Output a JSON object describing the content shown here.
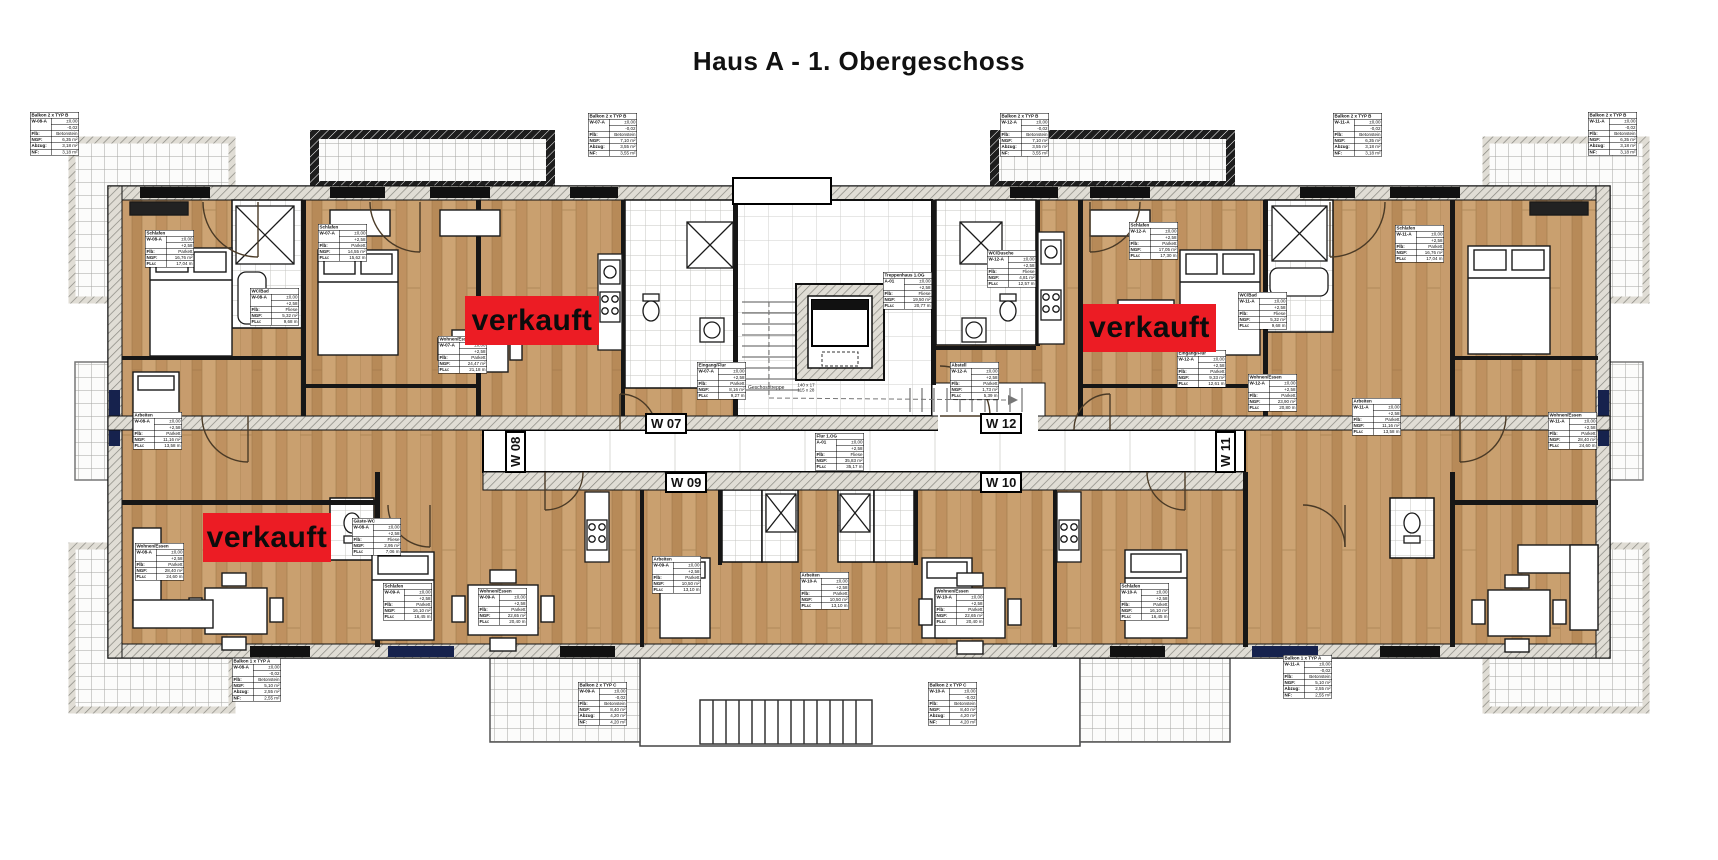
{
  "title": "Haus A - 1. Obergeschoss",
  "colors": {
    "sold_red": "#ec1c24",
    "wood_base": "#c49a6a",
    "wall_hatch": "#e0ddd5",
    "wall_dark": "#161616",
    "window_blue": "#16224d"
  },
  "sold_labels": [
    {
      "text": "verkauft",
      "x": 465,
      "y": 296,
      "w": 134,
      "h": 49
    },
    {
      "text": "verkauft",
      "x": 1083,
      "y": 304,
      "w": 133,
      "h": 48
    },
    {
      "text": "verkauft",
      "x": 203,
      "y": 513,
      "w": 128,
      "h": 49
    }
  ],
  "apartment_labels": [
    {
      "text": "W 07",
      "x": 645,
      "y": 413,
      "vertical": false
    },
    {
      "text": "W 08",
      "x": 505,
      "y": 473,
      "vertical": true
    },
    {
      "text": "W 09",
      "x": 665,
      "y": 472,
      "vertical": false
    },
    {
      "text": "W 10",
      "x": 980,
      "y": 472,
      "vertical": false
    },
    {
      "text": "W 11",
      "x": 1215,
      "y": 473,
      "vertical": true
    },
    {
      "text": "W 12",
      "x": 980,
      "y": 413,
      "vertical": false
    }
  ],
  "stair_note": {
    "label": "Geschosstreppe",
    "dims": [
      "140 x 17",
      "115 x 28"
    ],
    "x": 748,
    "y": 383
  },
  "tables": [
    {
      "x": 30,
      "y": 112,
      "title": "Balkon 2 x TYP B",
      "unit": "W-08-A",
      "levels": [
        "±0,00",
        "-0,02"
      ],
      "rows": [
        [
          "Flb:",
          "Betonstein"
        ],
        [
          "NGF:",
          "6,35 m²"
        ],
        [
          "Abzug:",
          "3,18 m²"
        ],
        [
          "NF:",
          "3,18 m²"
        ]
      ]
    },
    {
      "x": 588,
      "y": 113,
      "title": "Balkon 2 x TYP B",
      "unit": "W-07-A",
      "levels": [
        "±0,00",
        "-0,02"
      ],
      "rows": [
        [
          "Flb:",
          "Betonstein"
        ],
        [
          "NGF:",
          "7,10 m²"
        ],
        [
          "Abzug:",
          "3,55 m²"
        ],
        [
          "NF:",
          "3,55 m²"
        ]
      ]
    },
    {
      "x": 1000,
      "y": 113,
      "title": "Balkon 2 x TYP B",
      "unit": "W-12-A",
      "levels": [
        "±0,00",
        "-0,02"
      ],
      "rows": [
        [
          "Flb:",
          "Betonstein"
        ],
        [
          "NGF:",
          "7,10 m²"
        ],
        [
          "Abzug:",
          "3,55 m²"
        ],
        [
          "NF:",
          "3,55 m²"
        ]
      ]
    },
    {
      "x": 1333,
      "y": 113,
      "title": "Balkon 2 x TYP B",
      "unit": "W-11-A",
      "levels": [
        "±0,00",
        "-0,02"
      ],
      "rows": [
        [
          "Flb:",
          "Betonstein"
        ],
        [
          "NGF:",
          "6,35 m²"
        ],
        [
          "Abzug:",
          "3,18 m²"
        ],
        [
          "NF:",
          "3,18 m²"
        ]
      ]
    },
    {
      "x": 1588,
      "y": 112,
      "title": "Balkon 2 x TYP B",
      "unit": "W-11-A",
      "levels": [
        "±0,00",
        "-0,02"
      ],
      "rows": [
        [
          "Flb:",
          "Betonstein"
        ],
        [
          "NGF:",
          "6,35 m²"
        ],
        [
          "Abzug:",
          "3,18 m²"
        ],
        [
          "NF:",
          "3,18 m²"
        ]
      ]
    },
    {
      "x": 232,
      "y": 658,
      "title": "Balkon 1 x TYP A",
      "unit": "W-08-A",
      "levels": [
        "±0,00",
        "-0,02"
      ],
      "rows": [
        [
          "Flb:",
          "Betonstein"
        ],
        [
          "NGF:",
          "5,10 m²"
        ],
        [
          "Abzug:",
          "2,55 m²"
        ],
        [
          "NF:",
          "2,55 m²"
        ]
      ]
    },
    {
      "x": 578,
      "y": 682,
      "title": "Balkon 2 x TYP C",
      "unit": "W-09-A",
      "levels": [
        "±0,00",
        "-0,02"
      ],
      "rows": [
        [
          "Flb:",
          "Betonstein"
        ],
        [
          "NGF:",
          "8,40 m²"
        ],
        [
          "Abzug:",
          "4,20 m²"
        ],
        [
          "NF:",
          "4,20 m²"
        ]
      ]
    },
    {
      "x": 928,
      "y": 682,
      "title": "Balkon 2 x TYP C",
      "unit": "W-10-A",
      "levels": [
        "±0,00",
        "-0,02"
      ],
      "rows": [
        [
          "Flb:",
          "Betonstein"
        ],
        [
          "NGF:",
          "8,40 m²"
        ],
        [
          "Abzug:",
          "4,20 m²"
        ],
        [
          "NF:",
          "4,20 m²"
        ]
      ]
    },
    {
      "x": 1283,
      "y": 655,
      "title": "Balkon 1 x TYP A",
      "unit": "W-11-A",
      "levels": [
        "±0,00",
        "-0,02"
      ],
      "rows": [
        [
          "Flb:",
          "Betonstein"
        ],
        [
          "NGF:",
          "5,10 m²"
        ],
        [
          "Abzug:",
          "2,55 m²"
        ],
        [
          "NF:",
          "2,55 m²"
        ]
      ]
    },
    {
      "x": 145,
      "y": 230,
      "title": "Schlafen",
      "unit": "W-08-A",
      "levels": [
        "±0,00",
        "+2,58"
      ],
      "rows": [
        [
          "Flb:",
          "Parkett"
        ],
        [
          "NGF:",
          "16,76 m²"
        ],
        [
          "FLu:",
          "17,04 m"
        ]
      ]
    },
    {
      "x": 250,
      "y": 288,
      "title": "WC/Bad",
      "unit": "W-08-A",
      "levels": [
        "±0,00",
        "+2,58"
      ],
      "rows": [
        [
          "Flb:",
          "Fliese"
        ],
        [
          "NGF:",
          "5,32 m²"
        ],
        [
          "FLu:",
          "9,68 m"
        ]
      ]
    },
    {
      "x": 318,
      "y": 224,
      "title": "Schlafen",
      "unit": "W-07-A",
      "levels": [
        "±0,00",
        "+2,58"
      ],
      "rows": [
        [
          "Flb:",
          "Parkett"
        ],
        [
          "NGF:",
          "14,55 m²"
        ],
        [
          "FLu:",
          "15,62 m"
        ]
      ]
    },
    {
      "x": 438,
      "y": 336,
      "title": "Wohnen/Essen",
      "unit": "W-07-A",
      "levels": [
        "±0,00",
        "+2,58"
      ],
      "rows": [
        [
          "Flb:",
          "Parkett"
        ],
        [
          "NGF:",
          "24,47 m²"
        ],
        [
          "FLu:",
          "21,18 m"
        ]
      ]
    },
    {
      "x": 697,
      "y": 362,
      "title": "Eingang/Flur",
      "unit": "W-07-A",
      "levels": [
        "±0,00",
        "+2,58"
      ],
      "rows": [
        [
          "Flb:",
          "Parkett"
        ],
        [
          "NGF:",
          "8,16 m²"
        ],
        [
          "FLu:",
          "9,27 m"
        ]
      ]
    },
    {
      "x": 883,
      "y": 272,
      "title": "Treppenhaus 1.OG",
      "unit": "A-01",
      "levels": [
        "±0,00",
        "+2,58"
      ],
      "rows": [
        [
          "Flb:",
          "Fliese"
        ],
        [
          "NGF:",
          "19,50 m²"
        ],
        [
          "FLu:",
          "20,77 m"
        ]
      ]
    },
    {
      "x": 987,
      "y": 250,
      "title": "WC/Dusche",
      "unit": "W-12-A",
      "levels": [
        "±0,00",
        "+2,58"
      ],
      "rows": [
        [
          "Flb:",
          "Fliese"
        ],
        [
          "NGF:",
          "4,81 m²"
        ],
        [
          "FLu:",
          "12,57 m"
        ]
      ]
    },
    {
      "x": 950,
      "y": 362,
      "title": "Abstell",
      "unit": "W-12-A",
      "levels": [
        "±0,00",
        "+2,58"
      ],
      "rows": [
        [
          "Flb:",
          "Parkett"
        ],
        [
          "NGF:",
          "1,73 m²"
        ],
        [
          "FLu:",
          "5,39 m"
        ]
      ]
    },
    {
      "x": 1177,
      "y": 350,
      "title": "Eingang/Flur",
      "unit": "W-12-A",
      "levels": [
        "±0,00",
        "+2,58"
      ],
      "rows": [
        [
          "Flb:",
          "Parkett"
        ],
        [
          "NGF:",
          "9,33 m²"
        ],
        [
          "FLu:",
          "12,61 m"
        ]
      ]
    },
    {
      "x": 1248,
      "y": 374,
      "title": "Wohnen/Essen",
      "unit": "W-12-A",
      "levels": [
        "±0,00",
        "+2,58"
      ],
      "rows": [
        [
          "Flb:",
          "Parkett"
        ],
        [
          "NGF:",
          "23,90 m²"
        ],
        [
          "FLu:",
          "20,80 m"
        ]
      ]
    },
    {
      "x": 815,
      "y": 433,
      "title": "Flur 1.OG",
      "unit": "A-01",
      "levels": [
        "±0,00",
        "+2,58"
      ],
      "rows": [
        [
          "Flb:",
          "Fliese"
        ],
        [
          "NGF:",
          "35,83 m²"
        ],
        [
          "FLu:",
          "35,17 m"
        ]
      ]
    },
    {
      "x": 352,
      "y": 518,
      "title": "Gäste-WC",
      "unit": "W-08-A",
      "levels": [
        "±0,00",
        "+2,58"
      ],
      "rows": [
        [
          "Flb:",
          "Fliese"
        ],
        [
          "NGF:",
          "2,95 m²"
        ],
        [
          "FLu:",
          "7,06 m"
        ]
      ]
    },
    {
      "x": 1129,
      "y": 222,
      "title": "Schlafen",
      "unit": "W-12-A",
      "levels": [
        "±0,00",
        "+2,58"
      ],
      "rows": [
        [
          "Flb:",
          "Parkett"
        ],
        [
          "NGF:",
          "17,05 m²"
        ],
        [
          "FLu:",
          "17,30 m"
        ]
      ]
    },
    {
      "x": 1395,
      "y": 225,
      "title": "Schlafen",
      "unit": "W-11-A",
      "levels": [
        "±0,00",
        "+2,58"
      ],
      "rows": [
        [
          "Flb:",
          "Parkett"
        ],
        [
          "NGF:",
          "16,76 m²"
        ],
        [
          "FLu:",
          "17,04 m"
        ]
      ]
    },
    {
      "x": 1238,
      "y": 292,
      "title": "WC/Bad",
      "unit": "W-11-A",
      "levels": [
        "±0,00",
        "+2,58"
      ],
      "rows": [
        [
          "Flb:",
          "Fliese"
        ],
        [
          "NGF:",
          "5,32 m²"
        ],
        [
          "FLu:",
          "9,68 m"
        ]
      ]
    },
    {
      "x": 133,
      "y": 412,
      "title": "Arbeiten",
      "unit": "W-08-A",
      "levels": [
        "±0,00",
        "+2,58"
      ],
      "rows": [
        [
          "Flb:",
          "Parkett"
        ],
        [
          "NGF:",
          "11,16 m²"
        ],
        [
          "FLu:",
          "13,58 m"
        ]
      ]
    },
    {
      "x": 135,
      "y": 543,
      "title": "Wohnen/Essen",
      "unit": "W-08-A",
      "levels": [
        "±0,00",
        "+2,58"
      ],
      "rows": [
        [
          "Flb:",
          "Parkett"
        ],
        [
          "NGF:",
          "28,40 m²"
        ],
        [
          "FLu:",
          "24,60 m"
        ]
      ]
    },
    {
      "x": 383,
      "y": 583,
      "title": "Schlafen",
      "unit": "W-09-A",
      "levels": [
        "±0,00",
        "+2,58"
      ],
      "rows": [
        [
          "Flb:",
          "Parkett"
        ],
        [
          "NGF:",
          "16,10 m²"
        ],
        [
          "FLu:",
          "16,45 m"
        ]
      ]
    },
    {
      "x": 478,
      "y": 588,
      "title": "Wohnen/Essen",
      "unit": "W-09-A",
      "levels": [
        "±0,00",
        "+2,58"
      ],
      "rows": [
        [
          "Flb:",
          "Parkett"
        ],
        [
          "NGF:",
          "22,65 m²"
        ],
        [
          "FLu:",
          "20,40 m"
        ]
      ]
    },
    {
      "x": 652,
      "y": 556,
      "title": "Arbeiten",
      "unit": "W-09-A",
      "levels": [
        "±0,00",
        "+2,58"
      ],
      "rows": [
        [
          "Flb:",
          "Parkett"
        ],
        [
          "NGF:",
          "10,50 m²"
        ],
        [
          "FLu:",
          "13,10 m"
        ]
      ]
    },
    {
      "x": 800,
      "y": 572,
      "title": "Arbeiten",
      "unit": "W-10-A",
      "levels": [
        "±0,00",
        "+2,58"
      ],
      "rows": [
        [
          "Flb:",
          "Parkett"
        ],
        [
          "NGF:",
          "10,50 m²"
        ],
        [
          "FLu:",
          "13,10 m"
        ]
      ]
    },
    {
      "x": 935,
      "y": 588,
      "title": "Wohnen/Essen",
      "unit": "W-10-A",
      "levels": [
        "±0,00",
        "+2,58"
      ],
      "rows": [
        [
          "Flb:",
          "Parkett"
        ],
        [
          "NGF:",
          "22,65 m²"
        ],
        [
          "FLu:",
          "20,40 m"
        ]
      ]
    },
    {
      "x": 1120,
      "y": 583,
      "title": "Schlafen",
      "unit": "W-10-A",
      "levels": [
        "±0,00",
        "+2,58"
      ],
      "rows": [
        [
          "Flb:",
          "Parkett"
        ],
        [
          "NGF:",
          "16,10 m²"
        ],
        [
          "FLu:",
          "16,45 m"
        ]
      ]
    },
    {
      "x": 1352,
      "y": 398,
      "title": "Arbeiten",
      "unit": "W-11-A",
      "levels": [
        "±0,00",
        "+2,58"
      ],
      "rows": [
        [
          "Flb:",
          "Parkett"
        ],
        [
          "NGF:",
          "11,16 m²"
        ],
        [
          "FLu:",
          "13,58 m"
        ]
      ]
    },
    {
      "x": 1548,
      "y": 412,
      "title": "Wohnen/Essen",
      "unit": "W-11-A",
      "levels": [
        "±0,00",
        "+2,58"
      ],
      "rows": [
        [
          "Flb:",
          "Parkett"
        ],
        [
          "NGF:",
          "28,40 m²"
        ],
        [
          "FLu:",
          "24,60 m"
        ]
      ]
    }
  ]
}
